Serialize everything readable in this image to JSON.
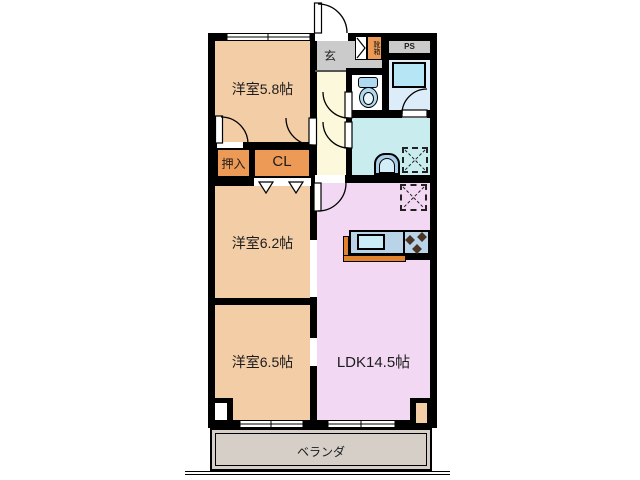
{
  "floorplan": {
    "rooms": {
      "bedroom_58": "洋室5.8帖",
      "bedroom_62": "洋室6.2帖",
      "bedroom_65": "洋室6.5帖",
      "ldk": "LDK14.5帖",
      "oshiire": "押入",
      "closet": "CL",
      "entrance": "玄",
      "shoe_cabinet": "靴箱",
      "pipe_space": "PS",
      "veranda": "ベランダ"
    },
    "colors": {
      "bedroom": "#f2cda6",
      "closet_orange": "#ec9a55",
      "ldk_pink": "#f2d8f3",
      "corridor_yellow": "#fcf8dc",
      "entrance_gray": "#cbcbcb",
      "washroom_cyan": "#c9ecef",
      "bathroom_blue": "#dcecf8",
      "bathtub_blue": "#b6e6f5",
      "fixture_blue": "#aed9f0",
      "counter_top": "#b9d3e8",
      "sink_blue": "#c9ecf6",
      "counter_edge": "#e0822e",
      "veranda_gray": "#d6cfc7",
      "wall": "#000000"
    }
  }
}
